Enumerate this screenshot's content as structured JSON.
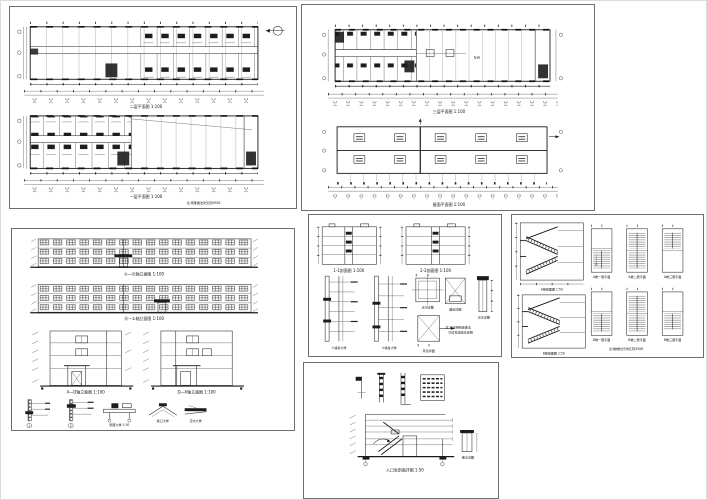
{
  "sheet": {
    "background": "#ffffff",
    "line_color": "#222222",
    "hatch_color": "#8f8f8f",
    "panel_border": "#6e6e6e"
  },
  "panels": {
    "plans": {
      "upper_plan_title": "二层平面图 1:100",
      "lower_plan_title": "一层平面图 1:100",
      "lower_plan_note": "注:雨蓬做法详见苏J9501",
      "north_arrow": "north-arrow"
    },
    "upper_right": {
      "plan_title": "三层平面图 1:100",
      "roof_title": "屋面平面图 1:100",
      "hall_label": "车间"
    },
    "elevations": {
      "front_title": "①—⑮轴立面图 1:100",
      "back_title": "⑮—①轴立面图 1:100",
      "side_a_title": "A—D轴立面图 1:100",
      "side_b_title": "D—A轴立面图 1:100",
      "detail_circle_1": "1",
      "detail_circle_2": "2",
      "canopy_label": "雨蓬大样 1:30",
      "eave_label": "檐口大样",
      "flashing_label": "泛水大样"
    },
    "sections": {
      "s1_title": "1-1剖面图 1:100",
      "s2_title": "2-2剖面图 1:100",
      "w1_title": "①墙身大样",
      "w2_title": "②墙身大样",
      "pa_title": "天沟详图",
      "pb_title": "烟道详图",
      "pc_title": "风道详图",
      "thin_title": "泛水详图",
      "note_line1": "注:未注明构造做法",
      "note_line2": "均详见建施总说明"
    },
    "stairs": {
      "sec1_title": "A梯剖面图 1:50",
      "sec2_title": "B梯剖面图 1:50",
      "plan_titles": [
        "A梯一层平面",
        "A梯二层平面",
        "A梯三层平面",
        "B梯一层平面",
        "B梯二层平面",
        "B梯三层平面"
      ],
      "note": "注:楼梯栏杆详见苏J9508"
    },
    "entry": {
      "title": "入口处剖面详图 1:50",
      "side_label": "散水详图"
    }
  }
}
